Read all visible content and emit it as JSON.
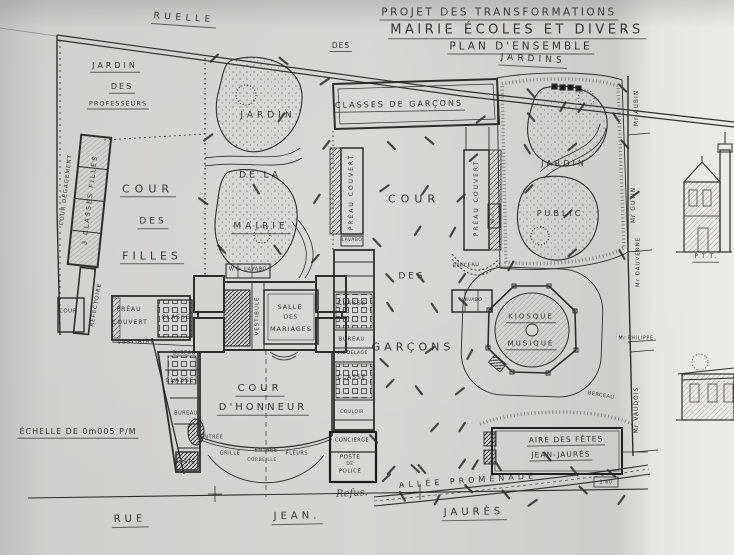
{
  "document_kind": "architectural site plan photograph",
  "palette": {
    "paper": "#d6d5d2",
    "ink": "#2b2926",
    "wall": "#1c1b19",
    "photo_border": "#0b0b0b"
  },
  "title_block": {
    "line1": "PROJET DES TRANSFORMATIONS",
    "line2": "MAIRIE ÉCOLES ET DIVERS",
    "prefix": "DES",
    "line3": "PLAN D'ENSEMBLE"
  },
  "scale_note": "ÉCHELLE DE 0m005 P/M",
  "streets": {
    "ruelle": "RUELLE",
    "jardins": "JARDINS",
    "rue": "RUE",
    "jean": "JEAN.",
    "jaures": "JAURÈS"
  },
  "handwritten_note": "Refus.",
  "elevation_label": "P.T.T.",
  "labels": [
    {
      "n": "jardin-professeurs-line1",
      "t": "JARDIN",
      "x": 115,
      "y": 67,
      "fs": 8,
      "ls": 3,
      "u": 1
    },
    {
      "n": "jardin-professeurs-line2",
      "t": "DES",
      "x": 122,
      "y": 88,
      "fs": 8,
      "ls": 2,
      "u": 1
    },
    {
      "n": "jardin-professeurs-line3",
      "t": "PROFESSEURS",
      "x": 118,
      "y": 105,
      "fs": 6.5,
      "ls": 1,
      "u": 1
    },
    {
      "n": "cour-degagement",
      "t": "COUR DÉGAGEMENT",
      "x": 67,
      "y": 190,
      "fs": 5.5,
      "rot": -83,
      "ls": 1
    },
    {
      "n": "classes-filles",
      "t": "3 CLASSES FILLES",
      "x": 90,
      "y": 200,
      "fs": 6.5,
      "rot": -83,
      "ls": 2
    },
    {
      "n": "cour-des-filles-line1",
      "t": "COUR",
      "x": 148,
      "y": 190,
      "fs": 11,
      "ls": 5,
      "u": 1
    },
    {
      "n": "cour-des-filles-line2",
      "t": "DES",
      "x": 153,
      "y": 223,
      "fs": 9,
      "ls": 3,
      "u": 1
    },
    {
      "n": "cour-des-filles-line3",
      "t": "FILLES",
      "x": 152,
      "y": 257,
      "fs": 11,
      "ls": 4,
      "u": 1
    },
    {
      "n": "jardin-mairie-line1",
      "t": "JARDIN",
      "x": 268,
      "y": 116,
      "fs": 9,
      "ls": 4
    },
    {
      "n": "jardin-mairie-line2",
      "t": "DE LA",
      "x": 260,
      "y": 176,
      "fs": 9,
      "ls": 3
    },
    {
      "n": "jardin-mairie-line3",
      "t": "MAIRIE",
      "x": 261,
      "y": 228,
      "fs": 9,
      "ls": 4,
      "u": 1
    },
    {
      "n": "classes-garcons",
      "t": "CLASSES DE GARÇONS",
      "x": 399,
      "y": 106,
      "fs": 8,
      "ls": 2,
      "rot": -1,
      "u": 1
    },
    {
      "n": "cour-garcons-line1",
      "t": "COUR",
      "x": 414,
      "y": 199,
      "fs": 11,
      "ls": 5
    },
    {
      "n": "cour-garcons-line2",
      "t": "DES",
      "x": 412,
      "y": 277,
      "fs": 9,
      "ls": 3
    },
    {
      "n": "cour-garcons-line3",
      "t": "GARÇONS",
      "x": 413,
      "y": 347,
      "fs": 11,
      "ls": 4
    },
    {
      "n": "jardin-public-line1",
      "t": "JARDIN",
      "x": 564,
      "y": 164,
      "fs": 8,
      "ls": 3
    },
    {
      "n": "jardin-public-line2",
      "t": "PUBLIC",
      "x": 560,
      "y": 214,
      "fs": 8,
      "ls": 3
    },
    {
      "n": "kiosque-line1",
      "t": "KIOSQUE",
      "x": 531,
      "y": 318,
      "fs": 7,
      "ls": 2,
      "u": 1
    },
    {
      "n": "kiosque-line2",
      "t": "MUSIQUE",
      "x": 531,
      "y": 345,
      "fs": 7,
      "ls": 2,
      "u": 1
    },
    {
      "n": "cour-honneur-line1",
      "t": "COUR",
      "x": 260,
      "y": 390,
      "fs": 10,
      "ls": 4,
      "u": 1
    },
    {
      "n": "cour-honneur-line2",
      "t": "D'HONNEUR",
      "x": 263,
      "y": 409,
      "fs": 10,
      "ls": 3,
      "u": 1
    },
    {
      "n": "aire-fetes-line1",
      "t": "AIRE DES FÊTES",
      "x": 566,
      "y": 441,
      "fs": 7.5,
      "ls": 1,
      "u": 1,
      "rot": -1
    },
    {
      "n": "aire-fetes-line2",
      "t": "JEAN-JAURÈS",
      "x": 561,
      "y": 456,
      "fs": 7.5,
      "ls": 1,
      "u": 1,
      "rot": -1
    },
    {
      "n": "allee-promenade",
      "t": "ALLÉE PROMENADE",
      "x": 468,
      "y": 481,
      "fs": 8,
      "ls": 4,
      "rot": -4
    },
    {
      "n": "preau-couvert-ouest",
      "t": "PRÉAU COUVERT",
      "x": 352,
      "y": 192,
      "fs": 6,
      "rot": -90,
      "ls": 2
    },
    {
      "n": "preau-couvert-est",
      "t": "PRÉAU COUVERT",
      "x": 477,
      "y": 198,
      "fs": 6,
      "rot": -90,
      "ls": 2
    },
    {
      "n": "lavabo-ouest",
      "t": "LAVABO",
      "x": 352,
      "y": 241,
      "fs": 4.5,
      "ls": 0.5
    },
    {
      "n": "lavabo-est",
      "t": "LAVABO",
      "x": 472,
      "y": 301,
      "fs": 4.5,
      "ls": 0.5
    },
    {
      "n": "wc-est",
      "t": "W.C.",
      "x": 494,
      "y": 216,
      "fs": 4.5,
      "rot": -90
    },
    {
      "n": "berceau-1",
      "t": "BERCEAU",
      "x": 466,
      "y": 266,
      "fs": 5,
      "ls": 0.5,
      "rot": -3
    },
    {
      "n": "berceau-2",
      "t": "BERCEAU",
      "x": 601,
      "y": 396,
      "fs": 5,
      "ls": 0.5,
      "rot": 10
    },
    {
      "n": "refectoire",
      "t": "RÉFECTOIRE",
      "x": 97,
      "y": 305,
      "fs": 5.5,
      "rot": -80,
      "ls": 1
    },
    {
      "n": "petite-cour",
      "t": "COUR",
      "x": 68,
      "y": 312,
      "fs": 5.5,
      "ls": 0.5
    },
    {
      "n": "preau-filles-line1",
      "t": "PRÉAU",
      "x": 129,
      "y": 310,
      "fs": 6,
      "ls": 1
    },
    {
      "n": "preau-filles-line2",
      "t": "COUVERT",
      "x": 130,
      "y": 323,
      "fs": 6,
      "ls": 1
    },
    {
      "n": "classe-filles-sud",
      "t": "CLASSE",
      "x": 176,
      "y": 318,
      "fs": 6,
      "ls": 1
    },
    {
      "n": "vestiaire",
      "t": "VESTIAIRE",
      "x": 136,
      "y": 343,
      "fs": 5.5,
      "ls": 1,
      "rot": -2
    },
    {
      "n": "wc-lavabo",
      "t": "W.C. LAVABO",
      "x": 248,
      "y": 270,
      "fs": 5,
      "ls": 0.5
    },
    {
      "n": "vestibule",
      "t": "VESTIBULE",
      "x": 258,
      "y": 316,
      "fs": 5.5,
      "rot": -90,
      "ls": 1
    },
    {
      "n": "salle-mariages-line1",
      "t": "SALLE",
      "x": 290,
      "y": 307,
      "fs": 6.5,
      "ls": 1
    },
    {
      "n": "salle-mariages-line2",
      "t": "DES",
      "x": 291,
      "y": 318,
      "fs": 5.5,
      "ls": 1
    },
    {
      "n": "salle-mariages-line3",
      "t": "MARIAGES",
      "x": 291,
      "y": 329,
      "fs": 6.5,
      "ls": 1
    },
    {
      "n": "classe-centre-nord",
      "t": "CLASSE",
      "x": 352,
      "y": 304,
      "fs": 6,
      "ls": 1
    },
    {
      "n": "bureau-centre",
      "t": "BUREAU",
      "x": 352,
      "y": 340,
      "fs": 5,
      "ls": 1
    },
    {
      "n": "modelage",
      "t": "MODELAGE",
      "x": 353,
      "y": 354,
      "fs": 4.5,
      "ls": 0.5
    },
    {
      "n": "classe-centre-sud",
      "t": "CLASSE",
      "x": 352,
      "y": 378,
      "fs": 6,
      "ls": 1
    },
    {
      "n": "couloir",
      "t": "COULOIR",
      "x": 352,
      "y": 413,
      "fs": 4.5,
      "ls": 0.5
    },
    {
      "n": "concierge",
      "t": "CONCIERGE",
      "x": 352,
      "y": 441,
      "fs": 5,
      "ls": 0.5
    },
    {
      "n": "poste-police-line1",
      "t": "POSTE",
      "x": 350,
      "y": 458,
      "fs": 5.5,
      "ls": 0.5
    },
    {
      "n": "poste-police-line2",
      "t": "DE",
      "x": 350,
      "y": 465,
      "fs": 4.5,
      "ls": 0.5
    },
    {
      "n": "poste-police-line3",
      "t": "POLICE",
      "x": 350,
      "y": 472,
      "fs": 5.5,
      "ls": 0.5
    },
    {
      "n": "classe-honneur-ouest",
      "t": "CLASSE",
      "x": 180,
      "y": 381,
      "fs": 6,
      "ls": 1
    },
    {
      "n": "bureau-honneur-nord",
      "t": "BUREAU",
      "x": 184,
      "y": 355,
      "fs": 4.8,
      "ls": 0.5
    },
    {
      "n": "bureau-honneur-sud",
      "t": "BUREAU",
      "x": 186,
      "y": 414,
      "fs": 5,
      "ls": 0.5
    },
    {
      "n": "entree-ouest",
      "t": "ENTRÉE",
      "x": 212,
      "y": 438,
      "fs": 5,
      "ls": 0.5
    },
    {
      "n": "grille",
      "t": "GRILLE",
      "x": 230,
      "y": 454,
      "fs": 5,
      "ls": 0.5
    },
    {
      "n": "entree-centre",
      "t": "ENTRÉE",
      "x": 266,
      "y": 451,
      "fs": 5,
      "ls": 0.5
    },
    {
      "n": "fleurs",
      "t": "FLEURS",
      "x": 297,
      "y": 454,
      "fs": 5,
      "ls": 0.5
    },
    {
      "n": "corbeille",
      "t": "CORBEILLE",
      "x": 262,
      "y": 461,
      "fs": 4.5,
      "ls": 0.5
    },
    {
      "n": "poste-sud-ouest",
      "t": "POSTE",
      "x": 185,
      "y": 463,
      "fs": 5.5,
      "ls": 0.5
    },
    {
      "n": "owner-aubin",
      "t": "Mr AUBIN",
      "x": 637,
      "y": 108,
      "fs": 6,
      "rot": -90,
      "ls": 1
    },
    {
      "n": "owner-gutin",
      "t": "Mr GUTIN",
      "x": 634,
      "y": 205,
      "fs": 6,
      "rot": -90,
      "ls": 1
    },
    {
      "n": "owner-dauverne",
      "t": "Mr DAUVERNE",
      "x": 639,
      "y": 262,
      "fs": 5.5,
      "rot": -90,
      "ls": 1
    },
    {
      "n": "owner-philippe",
      "t": "Mr PHILIPPE",
      "x": 636,
      "y": 339,
      "fs": 5,
      "ls": 0.5
    },
    {
      "n": "owner-vaudois",
      "t": "Mr VAUDOIS",
      "x": 637,
      "y": 410,
      "fs": 6,
      "rot": -90,
      "ls": 1
    },
    {
      "n": "dim-1-60",
      "t": "1·60",
      "x": 606,
      "y": 483,
      "fs": 5,
      "ls": 0.5
    }
  ]
}
